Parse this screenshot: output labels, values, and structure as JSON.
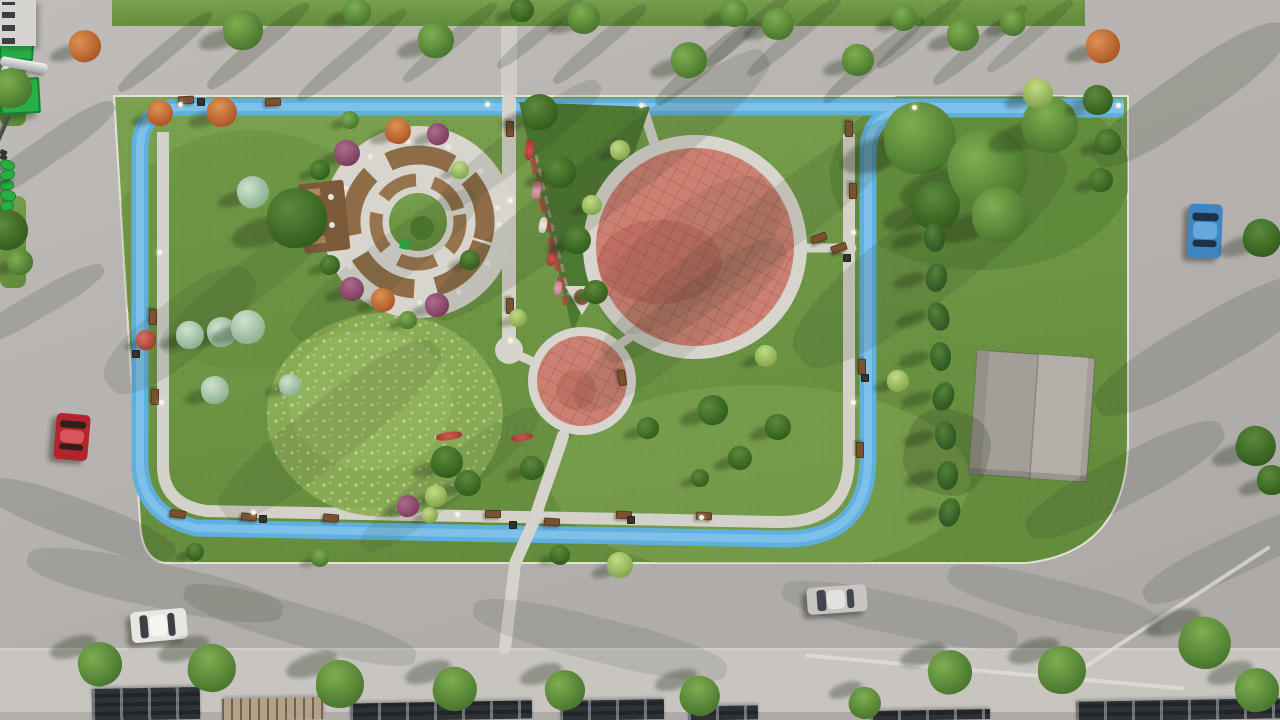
{
  "colors": {
    "grass": "#6f9a47",
    "grassDark": "#597f34",
    "grassLight": "#8fb15c",
    "meadow": "#8bad57",
    "road": "#b6b2af",
    "sidewalk": "#c8c5c1",
    "pathGray": "#d6d3cc",
    "trackBlue": "#60b0df",
    "trackBlueLight": "#8ac8ee",
    "playPink": "#cc8072",
    "paved": "#d8d5ce",
    "ringBrown": "#8d6c47",
    "deckBrown": "#7d5a3a",
    "benchBrown": "#7a5230",
    "canopyGreen": "#27ae45",
    "slideSilver": "#d9dadc",
    "roofLight": "#aaa69f",
    "roofDark": "#2e3136",
    "roofStripe": "#b5a189",
    "cypress": "#3c6a2e",
    "treeGreen": "#4e7c30",
    "treeLight": "#a9c86a",
    "tealShrub": "#9cc2a6",
    "orangeTree": "#c4702f",
    "purpleTree": "#8e4a6e",
    "flowerRed": "#c03c3c",
    "flowerPink": "#d98ca0",
    "flowerWhite": "#ece9df",
    "shadowInk": "#22301a",
    "carRed": "#b3252c",
    "carWhite": "#e8e6e1",
    "carSilver": "#c6c5c3",
    "carBlue": "#3e85c2"
  },
  "objects": {
    "streaks": [
      [
        165,
        52,
        120,
        16,
        -40,
        0.2
      ],
      [
        258,
        46,
        130,
        18,
        -40,
        0.2
      ],
      [
        352,
        55,
        140,
        16,
        -40,
        0.18
      ],
      [
        450,
        42,
        120,
        15,
        -40,
        0.18
      ],
      [
        540,
        32,
        110,
        14,
        -40,
        0.18
      ],
      [
        600,
        44,
        120,
        16,
        -40,
        0.18
      ],
      [
        706,
        62,
        130,
        18,
        -40,
        0.2
      ],
      [
        748,
        30,
        110,
        14,
        -40,
        0.18
      ],
      [
        794,
        36,
        120,
        15,
        -40,
        0.18
      ],
      [
        874,
        60,
        130,
        16,
        -40,
        0.2
      ],
      [
        920,
        32,
        110,
        14,
        -40,
        0.18
      ],
      [
        980,
        45,
        120,
        16,
        -40,
        0.18
      ],
      [
        1030,
        36,
        110,
        14,
        -40,
        0.16
      ],
      [
        600,
        185,
        420,
        60,
        -38,
        0.13
      ],
      [
        755,
        240,
        380,
        60,
        -38,
        0.12
      ],
      [
        930,
        255,
        330,
        85,
        -38,
        0.13
      ],
      [
        520,
        145,
        200,
        36,
        -38,
        0.12
      ],
      [
        385,
        265,
        230,
        46,
        -38,
        0.1
      ],
      [
        330,
        430,
        270,
        60,
        -38,
        0.11
      ],
      [
        680,
        325,
        260,
        56,
        -38,
        0.11
      ],
      [
        245,
        285,
        210,
        40,
        -38,
        0.1
      ],
      [
        450,
        480,
        220,
        40,
        -38,
        0.1
      ],
      [
        180,
        330,
        180,
        60,
        -38,
        0.12
      ],
      [
        690,
        255,
        210,
        90,
        -38,
        0.09
      ],
      [
        1190,
        95,
        230,
        50,
        -35,
        0.17
      ],
      [
        1205,
        345,
        250,
        55,
        -30,
        0.15
      ],
      [
        1125,
        480,
        220,
        48,
        -28,
        0.14
      ],
      [
        1235,
        555,
        200,
        40,
        -25,
        0.13
      ],
      [
        48,
        150,
        160,
        28,
        -35,
        0.17
      ],
      [
        38,
        305,
        150,
        26,
        -30,
        0.15
      ],
      [
        80,
        520,
        200,
        40,
        20,
        0.15
      ],
      [
        155,
        585,
        260,
        44,
        12,
        0.13
      ],
      [
        300,
        625,
        240,
        40,
        16,
        0.12
      ],
      [
        600,
        640,
        260,
        44,
        14,
        0.11
      ],
      [
        900,
        615,
        240,
        40,
        12,
        0.11
      ],
      [
        1055,
        600,
        220,
        40,
        14,
        0.11
      ],
      [
        947,
        452,
        84,
        84,
        16,
        0.2
      ]
    ],
    "trees": [
      [
        "round",
        243,
        30,
        20
      ],
      [
        "round",
        357,
        12,
        14
      ],
      [
        "round",
        436,
        40,
        18
      ],
      [
        "dark",
        522,
        10,
        12
      ],
      [
        "round",
        584,
        18,
        16
      ],
      [
        "round",
        689,
        60,
        18
      ],
      [
        "round",
        734,
        13,
        14
      ],
      [
        "round",
        778,
        24,
        16
      ],
      [
        "round",
        858,
        60,
        16
      ],
      [
        "round",
        904,
        18,
        13
      ],
      [
        "round",
        963,
        35,
        16
      ],
      [
        "round",
        1013,
        23,
        13
      ],
      [
        "orange",
        85,
        46,
        16
      ],
      [
        "orange",
        160,
        113,
        13
      ],
      [
        "orange",
        222,
        112,
        15
      ],
      [
        "orange",
        1103,
        46,
        17
      ],
      [
        "round",
        12,
        88,
        20
      ],
      [
        "dark",
        8,
        230,
        20
      ],
      [
        "round",
        20,
        262,
        13
      ],
      [
        "teal",
        253,
        192,
        16
      ],
      [
        "dark",
        297,
        218,
        30
      ],
      [
        "teal",
        222,
        332,
        15
      ],
      [
        "teal",
        190,
        335,
        14
      ],
      [
        "teal",
        248,
        327,
        17
      ],
      [
        "teal",
        215,
        390,
        14
      ],
      [
        "teal",
        290,
        385,
        11
      ],
      [
        "redbush",
        146,
        340,
        10
      ],
      [
        "purple",
        347,
        153,
        13
      ],
      [
        "purple",
        352,
        289,
        12
      ],
      [
        "purple",
        438,
        134,
        11
      ],
      [
        "purple",
        437,
        305,
        12
      ],
      [
        "orange",
        398,
        131,
        13
      ],
      [
        "orange",
        383,
        300,
        12
      ],
      [
        "dark",
        320,
        170,
        10
      ],
      [
        "dark",
        330,
        265,
        10
      ],
      [
        "light",
        460,
        170,
        9
      ],
      [
        "dark",
        470,
        260,
        10
      ],
      [
        "round",
        408,
        320,
        9
      ],
      [
        "round",
        350,
        120,
        9
      ],
      [
        "dark",
        540,
        112,
        18
      ],
      [
        "dark",
        560,
        172,
        16
      ],
      [
        "dark",
        577,
        240,
        14
      ],
      [
        "light",
        592,
        205,
        10
      ],
      [
        "dark",
        596,
        292,
        12
      ],
      [
        "light",
        620,
        150,
        10
      ],
      [
        "round",
        920,
        138,
        36
      ],
      [
        "round",
        988,
        168,
        40
      ],
      [
        "round",
        1050,
        125,
        28
      ],
      [
        "round",
        1000,
        215,
        28
      ],
      [
        "dark",
        936,
        206,
        24
      ],
      [
        "light",
        1038,
        93,
        15
      ],
      [
        "dark",
        1098,
        100,
        15
      ],
      [
        "dark",
        1108,
        142,
        13
      ],
      [
        "dark",
        1101,
        180,
        12
      ],
      [
        "dark",
        1262,
        238,
        19
      ],
      [
        "dark",
        1256,
        446,
        20
      ],
      [
        "dark",
        1272,
        480,
        15
      ],
      [
        "dark",
        713,
        410,
        15
      ],
      [
        "dark",
        778,
        427,
        13
      ],
      [
        "dark",
        740,
        458,
        12
      ],
      [
        "light",
        766,
        356,
        11
      ],
      [
        "light",
        898,
        381,
        11
      ],
      [
        "dark",
        700,
        478,
        9
      ],
      [
        "dark",
        648,
        428,
        11
      ],
      [
        "dark",
        447,
        462,
        16
      ],
      [
        "dark",
        468,
        483,
        13
      ],
      [
        "dark",
        532,
        468,
        12
      ],
      [
        "light",
        436,
        496,
        11
      ],
      [
        "light",
        620,
        565,
        13
      ],
      [
        "dark",
        560,
        555,
        10
      ],
      [
        "purple",
        408,
        506,
        11
      ],
      [
        "light",
        430,
        515,
        8
      ],
      [
        "light",
        518,
        318,
        9
      ],
      [
        "dark",
        195,
        552,
        9
      ],
      [
        "round",
        320,
        558,
        9
      ],
      [
        "round",
        100,
        664,
        22,
        1
      ],
      [
        "round",
        212,
        668,
        24,
        1
      ],
      [
        "round",
        340,
        684,
        24,
        1
      ],
      [
        "round",
        455,
        689,
        22,
        1
      ],
      [
        "round",
        565,
        690,
        20,
        1
      ],
      [
        "round",
        700,
        696,
        20,
        1
      ],
      [
        "round",
        950,
        672,
        22,
        1
      ],
      [
        "round",
        1062,
        670,
        24,
        1
      ],
      [
        "round",
        1205,
        643,
        26,
        1
      ],
      [
        "round",
        1257,
        690,
        22,
        1
      ],
      [
        "round",
        865,
        703,
        16,
        1
      ],
      [
        "cypress",
        934,
        237,
        11
      ],
      [
        "cypress",
        936,
        277,
        11
      ],
      [
        "cypress",
        938,
        316,
        11
      ],
      [
        "cypress",
        940,
        356,
        11
      ],
      [
        "cypress",
        943,
        396,
        11
      ],
      [
        "cypress",
        945,
        435,
        11
      ],
      [
        "cypress",
        947,
        475,
        11
      ],
      [
        "cypress",
        949,
        512,
        11
      ]
    ],
    "benches": [
      [
        185,
        99,
        -3
      ],
      [
        272,
        101,
        -3
      ],
      [
        848,
        128,
        90
      ],
      [
        852,
        190,
        90
      ],
      [
        861,
        366,
        90
      ],
      [
        859,
        449,
        90
      ],
      [
        177,
        513,
        8
      ],
      [
        248,
        516,
        5
      ],
      [
        330,
        517,
        5
      ],
      [
        492,
        513,
        0
      ],
      [
        551,
        521,
        4
      ],
      [
        623,
        514,
        3
      ],
      [
        703,
        515,
        3
      ],
      [
        152,
        316,
        90
      ],
      [
        154,
        396,
        90
      ],
      [
        818,
        237,
        -20
      ],
      [
        838,
        247,
        -20
      ],
      [
        621,
        377,
        80
      ],
      [
        509,
        128,
        90
      ],
      [
        509,
        305,
        90
      ]
    ],
    "bins": [
      [
        262,
        518
      ],
      [
        512,
        524
      ],
      [
        846,
        257
      ],
      [
        864,
        377
      ],
      [
        630,
        519
      ],
      [
        200,
        101
      ],
      [
        135,
        353
      ]
    ],
    "lamps": [
      [
        180,
        104
      ],
      [
        487,
        104
      ],
      [
        641,
        105
      ],
      [
        914,
        107
      ],
      [
        1118,
        105
      ],
      [
        159,
        252
      ],
      [
        161,
        402
      ],
      [
        253,
        512
      ],
      [
        457,
        514
      ],
      [
        701,
        517
      ],
      [
        853,
        232
      ],
      [
        853,
        402
      ],
      [
        510,
        200
      ],
      [
        510,
        340
      ]
    ],
    "flowers": [
      [
        "red",
        449,
        436,
        26,
        8,
        -8
      ],
      [
        "red",
        522,
        437,
        22,
        7,
        -8
      ],
      [
        "red",
        529,
        150,
        9,
        20,
        8
      ],
      [
        "pink",
        536,
        190,
        9,
        18,
        10
      ],
      [
        "white",
        543,
        225,
        8,
        16,
        10
      ],
      [
        "red",
        551,
        258,
        9,
        16,
        12
      ],
      [
        "pink",
        558,
        288,
        8,
        14,
        12
      ]
    ],
    "cars": [
      {
        "name": "red-car",
        "x": 72,
        "y": 437,
        "w": 34,
        "h": 46,
        "rot": 5,
        "body": "#b3252c",
        "glass": "#311f1c",
        "trim": "#d8555a"
      },
      {
        "name": "white-van",
        "x": 159,
        "y": 625,
        "w": 56,
        "h": 31,
        "rot": -5,
        "body": "#e8e6e1",
        "glass": "#3c3f45",
        "trim": "#f7f5f1"
      },
      {
        "name": "silver-sedan",
        "x": 837,
        "y": 599,
        "w": 60,
        "h": 27,
        "rot": -4,
        "body": "#c6c5c3",
        "glass": "#43464c",
        "trim": "#e2e1df"
      },
      {
        "name": "blue-car",
        "x": 1205,
        "y": 231,
        "w": 34,
        "h": 54,
        "rot": 2,
        "body": "#3e85c2",
        "glass": "#1d3246",
        "trim": "#66a9dc"
      }
    ],
    "roofs": [
      [
        92,
        688,
        108,
        32,
        "dark"
      ],
      [
        222,
        698,
        102,
        22,
        "striped"
      ],
      [
        350,
        702,
        182,
        18,
        "dark"
      ],
      [
        560,
        700,
        104,
        20,
        "dark"
      ],
      [
        688,
        706,
        70,
        14,
        "dark"
      ],
      [
        870,
        710,
        120,
        10,
        "dark"
      ],
      [
        1076,
        700,
        204,
        20,
        "dark"
      ]
    ],
    "lightlines": [
      [
        1165,
        615,
        250,
        4,
        -33
      ],
      [
        995,
        672,
        380,
        4,
        5
      ]
    ],
    "playsets": [
      {
        "kind": "platform",
        "x": 705,
        "y": 217,
        "w": 20,
        "h": 18,
        "rot": 4
      },
      {
        "kind": "slide",
        "x": 748,
        "y": 228,
        "w": 32,
        "h": 9,
        "rot": 35
      },
      {
        "kind": "canopy",
        "x": 727,
        "y": 217,
        "w": 30,
        "h": 27,
        "rot": 4
      },
      {
        "kind": "slide-l",
        "x": 682,
        "y": 283,
        "w": 48,
        "h": 10,
        "rot": 10
      },
      {
        "kind": "slide",
        "x": 734,
        "y": 297,
        "w": 24,
        "h": 8,
        "rot": 30
      },
      {
        "kind": "canopy",
        "x": 718,
        "y": 283,
        "w": 36,
        "h": 32,
        "rot": -3
      },
      {
        "kind": "swingbeam",
        "x": 637,
        "y": 256,
        "w": 4,
        "h": 36,
        "rot": 24
      },
      {
        "kind": "seat",
        "x": 630,
        "y": 252,
        "w": 7,
        "h": 5,
        "rot": 24
      },
      {
        "kind": "seat",
        "x": 643,
        "y": 262,
        "w": 7,
        "h": 5,
        "rot": 24
      },
      {
        "kind": "springer",
        "x": 560,
        "y": 336,
        "w": 13,
        "h": 8,
        "rot": 20
      },
      {
        "kind": "springer",
        "x": 600,
        "y": 349,
        "w": 13,
        "h": 8,
        "rot": -15
      },
      {
        "kind": "springer",
        "x": 542,
        "y": 373,
        "w": 12,
        "h": 8,
        "rot": 0
      },
      {
        "kind": "springer",
        "x": 576,
        "y": 376,
        "w": 14,
        "h": 9,
        "rot": 10
      },
      {
        "kind": "springer",
        "x": 601,
        "y": 393,
        "w": 12,
        "h": 8,
        "rot": -20
      },
      {
        "kind": "springer",
        "x": 566,
        "y": 407,
        "w": 12,
        "h": 8,
        "rot": 15
      }
    ]
  }
}
